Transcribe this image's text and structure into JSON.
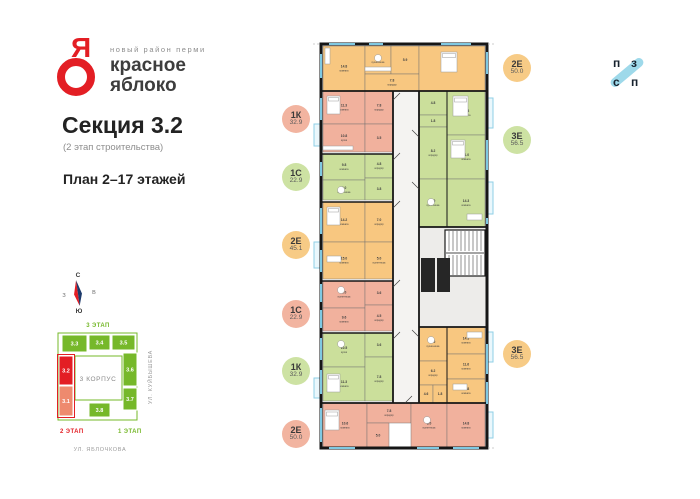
{
  "header": {
    "logo_letter": "Я",
    "tagline": "новый район перми",
    "brand_line1": "красное",
    "brand_line2": "яблоко",
    "section_title": "Секция 3.2",
    "section_subtitle": "(2 этап строительства)",
    "plan_title": "План 2–17 этажей"
  },
  "developer_logo": {
    "letters": [
      "п",
      "з",
      "с",
      "п"
    ]
  },
  "compass": {
    "north": "С",
    "south": "Ю",
    "west": "З",
    "east": "В"
  },
  "site_map": {
    "stage3_label": "3 ЭТАП",
    "stage2_label": "2 ЭТАП",
    "stage1_label": "1 ЭТАП",
    "building_label": "3 КОРПУС",
    "streets": [
      "УЛ. КУЙБЫШЕВА",
      "УЛ. ЯБЛОЧКОВА"
    ],
    "colors": {
      "green": "#76b82a",
      "red": "#e31e24",
      "salmon": "#ee8a6e"
    },
    "sections": [
      {
        "label": "3.3",
        "color": "#76b82a",
        "x": 14,
        "y": 15,
        "w": 25,
        "h": 17
      },
      {
        "label": "3.4",
        "color": "#76b82a",
        "x": 41,
        "y": 15,
        "w": 21,
        "h": 15
      },
      {
        "label": "3.5",
        "color": "#76b82a",
        "x": 64,
        "y": 15,
        "w": 23,
        "h": 15
      },
      {
        "label": "3.2",
        "color": "#e31e24",
        "x": 11,
        "y": 36,
        "w": 14,
        "h": 29
      },
      {
        "label": "3.1",
        "color": "#ee8a6e",
        "x": 11,
        "y": 66,
        "w": 14,
        "h": 30
      },
      {
        "label": "3.6",
        "color": "#76b82a",
        "x": 75,
        "y": 33,
        "w": 14,
        "h": 33
      },
      {
        "label": "3.7",
        "color": "#76b82a",
        "x": 75,
        "y": 68,
        "w": 14,
        "h": 22
      },
      {
        "label": "3.8",
        "color": "#76b82a",
        "x": 41,
        "y": 83,
        "w": 21,
        "h": 14
      }
    ]
  },
  "badges_left": [
    {
      "type": "1К",
      "area": "32.9",
      "color": "#f2b4a0"
    },
    {
      "type": "1С",
      "area": "22.9",
      "color": "#cde2a3"
    },
    {
      "type": "2Е",
      "area": "45.1",
      "color": "#f7cb86"
    },
    {
      "type": "1С",
      "area": "22.9",
      "color": "#f2b4a0"
    },
    {
      "type": "1К",
      "area": "32.9",
      "color": "#cde2a3"
    },
    {
      "type": "2Е",
      "area": "50.0",
      "color": "#f2b4a0"
    }
  ],
  "badges_right": [
    {
      "type": "2Е",
      "area": "50.0",
      "color": "#f7cb86"
    },
    {
      "type": "3Е",
      "area": "56.5",
      "color": "#cde2a3"
    },
    {
      "type": "3Е",
      "area": "56.5",
      "color": "#f7cb86"
    }
  ],
  "floor_plan": {
    "apartments": [
      {
        "id": "top-2E",
        "type": "2Е",
        "area": "50.0",
        "color": "#f8c780",
        "rooms": [
          {
            "name": "комната",
            "area": "14.8",
            "x": 2,
            "y": 2,
            "w": 42,
            "h": 45
          },
          {
            "name": "кухня-ниша",
            "area": "5.9",
            "x": 44,
            "y": 2,
            "w": 26,
            "h": 28
          },
          {
            "name": "",
            "area": "5.9",
            "x": 70,
            "y": 2,
            "w": 28,
            "h": 28
          },
          {
            "name": "коридор",
            "area": "7.8",
            "x": 44,
            "y": 30,
            "w": 54,
            "h": 17
          },
          {
            "name": "комната",
            "area": "16.5",
            "x": 98,
            "y": 2,
            "w": 66,
            "h": 45
          }
        ]
      },
      {
        "id": "left-1K",
        "type": "1К",
        "area": "32.9",
        "color": "#f1b19d",
        "rooms": [
          {
            "name": "комната",
            "area": "11.3",
            "x": 2,
            "y": 47,
            "w": 42,
            "h": 33
          },
          {
            "name": "кухня",
            "area": "10.8",
            "x": 2,
            "y": 80,
            "w": 42,
            "h": 28
          },
          {
            "name": "коридор",
            "area": "7.8",
            "x": 44,
            "y": 47,
            "w": 28,
            "h": 33
          },
          {
            "name": "",
            "area": "3.5",
            "x": 44,
            "y": 80,
            "w": 28,
            "h": 28
          }
        ]
      },
      {
        "id": "left-1S-upper",
        "type": "1С",
        "area": "22.9",
        "color": "#cbdf9b",
        "rooms": [
          {
            "name": "комната",
            "area": "9.8",
            "x": 2,
            "y": 110,
            "w": 42,
            "h": 26
          },
          {
            "name": "кухня-ниша",
            "area": "5.0",
            "x": 2,
            "y": 136,
            "w": 42,
            "h": 20
          },
          {
            "name": "коридор",
            "area": "4.8",
            "x": 44,
            "y": 110,
            "w": 28,
            "h": 24
          },
          {
            "name": "",
            "area": "3.8",
            "x": 44,
            "y": 134,
            "w": 28,
            "h": 22
          }
        ]
      },
      {
        "id": "left-2E",
        "type": "2Е",
        "area": "45.1",
        "color": "#f8c780",
        "rooms": [
          {
            "name": "комната",
            "area": "14.2",
            "x": 2,
            "y": 158,
            "w": 42,
            "h": 40
          },
          {
            "name": "комната",
            "area": "15.0",
            "x": 2,
            "y": 198,
            "w": 42,
            "h": 37
          },
          {
            "name": "коридор",
            "area": "7.0",
            "x": 44,
            "y": 158,
            "w": 28,
            "h": 40
          },
          {
            "name": "кухня-ниша",
            "area": "5.0",
            "x": 44,
            "y": 198,
            "w": 28,
            "h": 37
          }
        ]
      },
      {
        "id": "left-1S-lower",
        "type": "1С",
        "area": "22.9",
        "color": "#f1b19d",
        "rooms": [
          {
            "name": "кухня-ниша",
            "area": "5.0",
            "x": 2,
            "y": 237,
            "w": 42,
            "h": 27
          },
          {
            "name": "комната",
            "area": "9.6",
            "x": 2,
            "y": 264,
            "w": 42,
            "h": 23
          },
          {
            "name": "",
            "area": "3.6",
            "x": 44,
            "y": 237,
            "w": 28,
            "h": 24
          },
          {
            "name": "коридор",
            "area": "4.5",
            "x": 44,
            "y": 261,
            "w": 28,
            "h": 26
          }
        ]
      },
      {
        "id": "left-1K-lower",
        "type": "1К",
        "area": "32.9",
        "color": "#cbdf9b",
        "rooms": [
          {
            "name": "кухня",
            "area": "10.5",
            "x": 2,
            "y": 289,
            "w": 42,
            "h": 34
          },
          {
            "name": "комната",
            "area": "11.3",
            "x": 2,
            "y": 323,
            "w": 42,
            "h": 34
          },
          {
            "name": "",
            "area": "3.6",
            "x": 44,
            "y": 289,
            "w": 28,
            "h": 24
          },
          {
            "name": "коридор",
            "area": "7.8",
            "x": 44,
            "y": 313,
            "w": 28,
            "h": 44
          }
        ]
      },
      {
        "id": "bottom-2E",
        "type": "2Е",
        "area": "50.0",
        "color": "#f1b19d",
        "rooms": [
          {
            "name": "комната",
            "area": "10.6",
            "x": 2,
            "y": 359,
            "w": 44,
            "h": 45
          },
          {
            "name": "коридор",
            "area": "7.8",
            "x": 46,
            "y": 359,
            "w": 44,
            "h": 20
          },
          {
            "name": "",
            "area": "5.0",
            "x": 46,
            "y": 379,
            "w": 22,
            "h": 25
          },
          {
            "name": "кухня-ниша",
            "area": "6.0",
            "x": 90,
            "y": 359,
            "w": 36,
            "h": 45
          },
          {
            "name": "комната",
            "area": "14.8",
            "x": 126,
            "y": 359,
            "w": 38,
            "h": 45
          }
        ]
      },
      {
        "id": "right-3E-green",
        "type": "3Е",
        "area": "56.5",
        "color": "#cbdf9b",
        "rooms": [
          {
            "name": "",
            "area": "4.8",
            "x": 98,
            "y": 47,
            "w": 28,
            "h": 24
          },
          {
            "name": "",
            "area": "1.8",
            "x": 98,
            "y": 71,
            "w": 28,
            "h": 12
          },
          {
            "name": "коридор",
            "area": "8.2",
            "x": 98,
            "y": 83,
            "w": 28,
            "h": 52
          },
          {
            "name": "кухня-ниша",
            "area": "5.0",
            "x": 98,
            "y": 135,
            "w": 28,
            "h": 48
          },
          {
            "name": "комната",
            "area": "10.8",
            "x": 126,
            "y": 47,
            "w": 38,
            "h": 44
          },
          {
            "name": "комната",
            "area": "11.0",
            "x": 126,
            "y": 91,
            "w": 38,
            "h": 44
          },
          {
            "name": "комната",
            "area": "14.3",
            "x": 126,
            "y": 135,
            "w": 38,
            "h": 48
          }
        ]
      },
      {
        "id": "right-3E-orange",
        "type": "3Е",
        "area": "56.5",
        "color": "#f8c780",
        "rooms": [
          {
            "name": "кухня-ниша",
            "area": "5.0",
            "x": 98,
            "y": 283,
            "w": 28,
            "h": 34
          },
          {
            "name": "коридор",
            "area": "6.2",
            "x": 98,
            "y": 317,
            "w": 28,
            "h": 24
          },
          {
            "name": "",
            "area": "4.6",
            "x": 98,
            "y": 341,
            "w": 14,
            "h": 18
          },
          {
            "name": "",
            "area": "1.8",
            "x": 112,
            "y": 341,
            "w": 14,
            "h": 18
          },
          {
            "name": "комната",
            "area": "14.3",
            "x": 126,
            "y": 283,
            "w": 38,
            "h": 27
          },
          {
            "name": "комната",
            "area": "11.6",
            "x": 126,
            "y": 310,
            "w": 38,
            "h": 25
          },
          {
            "name": "комната",
            "area": "10.8",
            "x": 126,
            "y": 335,
            "w": 38,
            "h": 24
          }
        ]
      }
    ]
  }
}
